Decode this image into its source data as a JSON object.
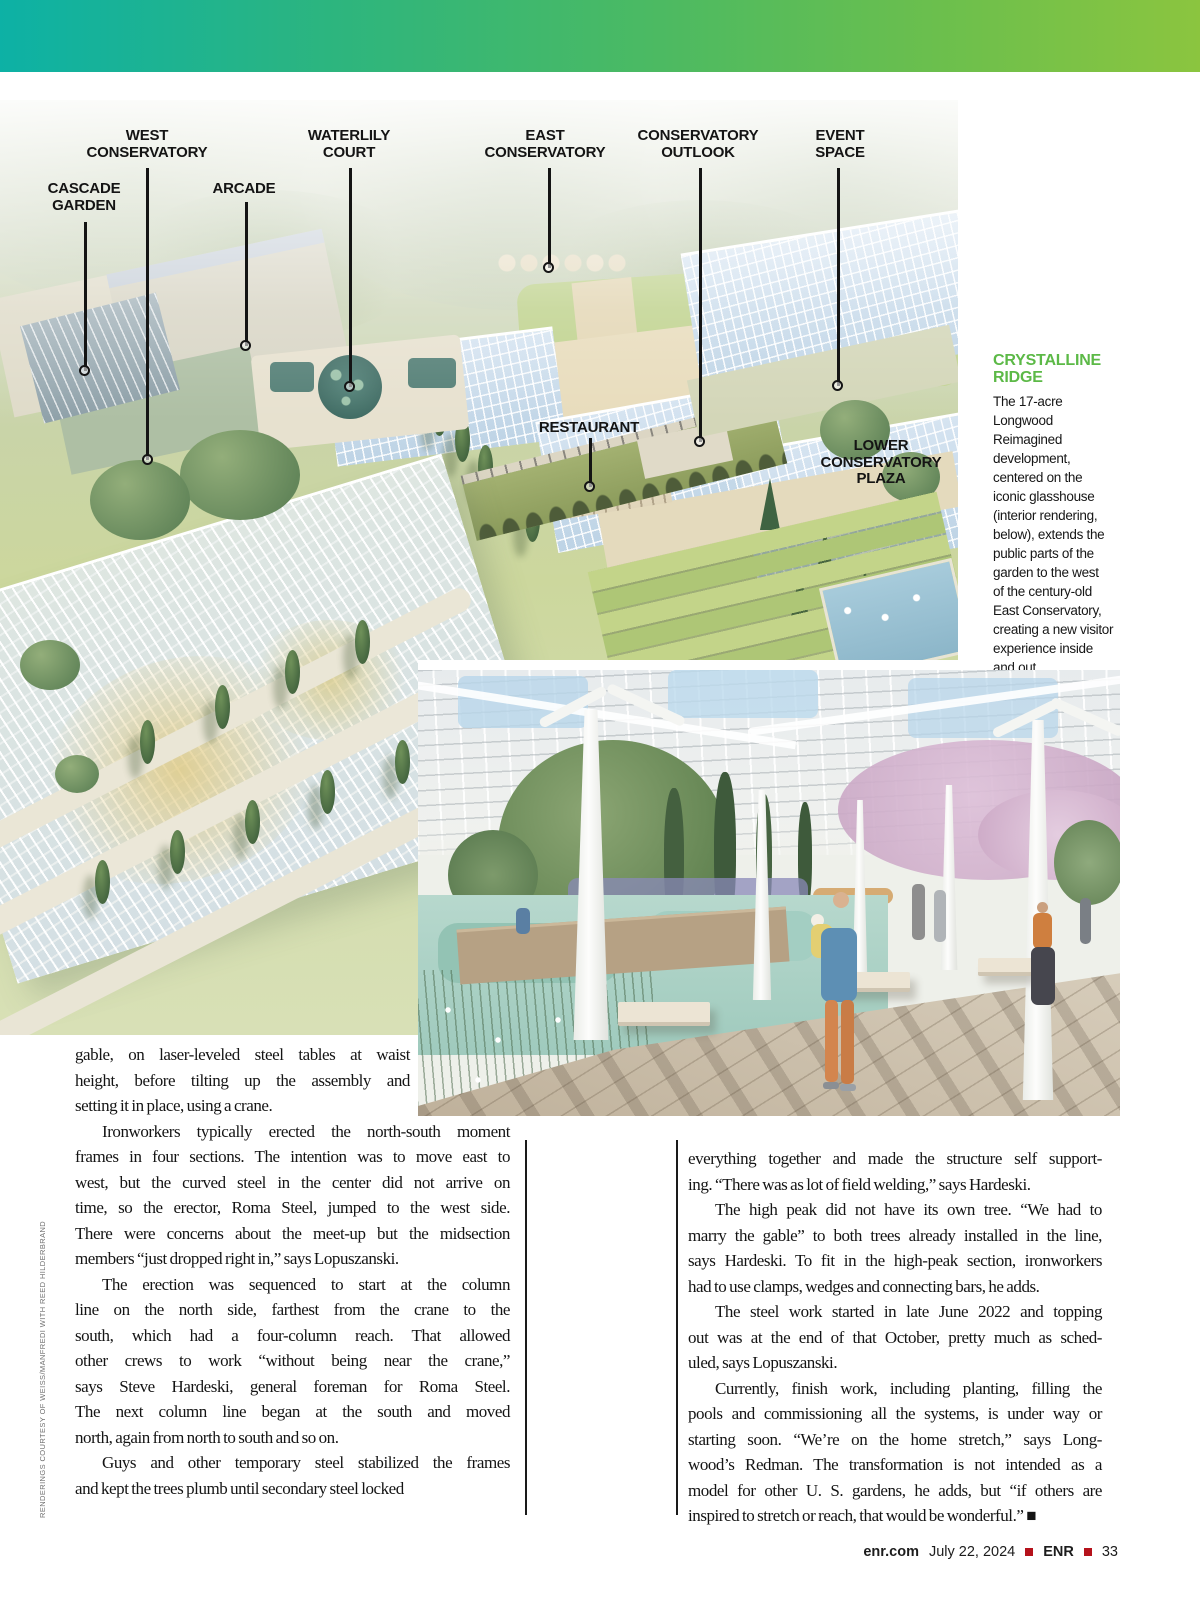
{
  "page": {
    "credit_vertical": "RENDERINGS COURTESY OF WEISS/MANFREDI WITH REED HILDERBRAND",
    "accent_green": "#5cb947",
    "topbar_gradient": [
      "#0db1a5",
      "#8bc53f"
    ],
    "footer": {
      "site": "enr.com",
      "date": "July 22, 2024",
      "brand": "ENR",
      "page_number": "33",
      "separator_color": "#b5121b"
    }
  },
  "aerial": {
    "callouts": [
      {
        "label": "WEST\nCONSERVATORY"
      },
      {
        "label": "CASCADE\nGARDEN"
      },
      {
        "label": "ARCADE"
      },
      {
        "label": "WATERLILY\nCOURT"
      },
      {
        "label": "EAST\nCONSERVATORY"
      },
      {
        "label": "CONSERVATORY\nOUTLOOK"
      },
      {
        "label": "EVENT\nSPACE"
      },
      {
        "label": "RESTAURANT"
      },
      {
        "label": "LOWER\nCONSERVATORY\nPLAZA"
      }
    ]
  },
  "sidebar": {
    "title": "CRYSTALLINE\nRIDGE",
    "body_lines": [
      "The 17-acre Longwood",
      "Reimagined",
      "development,",
      "centered on the",
      "iconic glasshouse",
      "(interior rendering,",
      "below), extends the",
      "public parts of the",
      "garden to the west",
      "of the century-old",
      "East Conservatory,",
      "creating a new visitor",
      "experience inside",
      "and out."
    ]
  },
  "article": {
    "col1_intro_lines": [
      "gable, on laser-leveled steel tables at waist",
      "height, before tilting up the assembly and",
      "setting it in place, using a crane."
    ],
    "col1_paragraphs": [
      {
        "indent": true,
        "lines": [
          "Ironworkers typically erected the north-south moment",
          "frames in four sections. The intention was to move east to",
          "west, but the curved steel in the center did not arrive on",
          "time, so the erector, Roma Steel, jumped to the west side.",
          "There were concerns about the meet-up but the midsection",
          "members “just dropped right in,” says Lopuszanski."
        ]
      },
      {
        "indent": true,
        "lines": [
          "The erection was sequenced to start at the column",
          "line on the north side, farthest from the crane to the",
          "south, which had a four-column reach. That allowed",
          "other crews to work “without being near the crane,”",
          "says Steve Hardeski, general foreman for Roma Steel.",
          "The next column line began at the south and moved",
          "north, again from north to south and so on."
        ]
      },
      {
        "indent": true,
        "lines": [
          "Guys and other temporary steel stabilized the frames",
          "and kept the trees plumb until secondary steel locked"
        ]
      }
    ],
    "col2_paragraphs": [
      {
        "indent": false,
        "lines": [
          "everything together and made the structure self support-",
          "ing. “There was as lot of field welding,” says Hardeski."
        ]
      },
      {
        "indent": true,
        "lines": [
          "The high peak did not have its own tree. “We had to",
          "marry the gable” to both trees already installed in the line,",
          "says Hardeski. To fit in the high-peak section, ironworkers",
          "had to use clamps, wedges and connecting bars, he adds."
        ]
      },
      {
        "indent": true,
        "lines": [
          "The steel work started in late June 2022 and topping",
          "out was at the end of that October, pretty much as sched-",
          "uled, says Lopuszanski."
        ]
      },
      {
        "indent": true,
        "lines": [
          "Currently, finish work, including planting, filling the",
          "pools and commissioning all the systems, is under way or",
          "starting soon. “We’re on the home stretch,” says Long-",
          "wood’s Redman. The transformation is not intended as a",
          "model for other U. S. gardens, he adds, but “if others are",
          "inspired to stretch or reach, that would be wonderful.” ■"
        ]
      }
    ]
  }
}
